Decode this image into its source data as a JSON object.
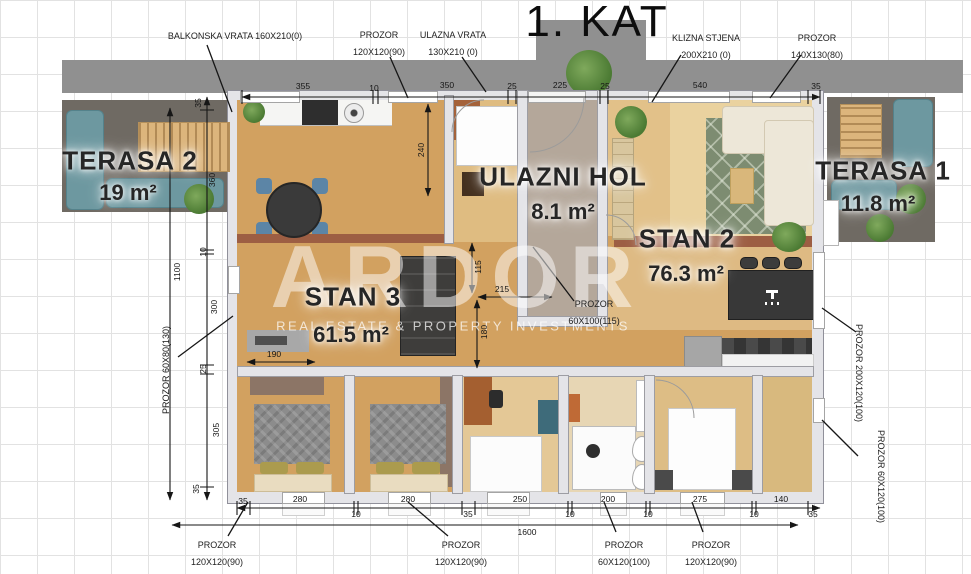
{
  "title": "1. KAT",
  "watermark": {
    "brand": "ARDOR",
    "tagline": "REAL ESTATE & PROPERTY INVESTMENTS"
  },
  "rooms": {
    "terasa2": {
      "name": "TERASA 2",
      "area": "19 m²"
    },
    "terasa1": {
      "name": "TERASA 1",
      "area": "11.8 m²"
    },
    "hol": {
      "name": "ULAZNI HOL",
      "area": "8.1 m²"
    },
    "stan2": {
      "name": "STAN 2",
      "area": "76.3 m²"
    },
    "stan3": {
      "name": "STAN 3",
      "area": "61.5 m²"
    }
  },
  "openings": {
    "top": [
      {
        "label": "BALKONSKA VRATA 160X210(0)",
        "size": ""
      },
      {
        "label": "PROZOR",
        "size": "120X120(90)"
      },
      {
        "label": "ULAZNA VRATA",
        "size": "130X210 (0)"
      },
      {
        "label": "KLIZNA STJENA",
        "size": "200X210 (0)"
      },
      {
        "label": "PROZOR",
        "size": "140X130(80)"
      }
    ],
    "bottom": [
      {
        "label": "PROZOR",
        "size": "120X120(90)"
      },
      {
        "label": "PROZOR",
        "size": "120X120(90)"
      },
      {
        "label": "PROZOR",
        "size": "60X120(100)"
      },
      {
        "label": "PROZOR",
        "size": "120X120(90)"
      }
    ],
    "left": {
      "label": "PROZOR 60X80(130)"
    },
    "right": [
      {
        "label": "PROZOR 200X120(100)"
      },
      {
        "label": "PROZOR 60X120(100)"
      }
    ],
    "center": {
      "label": "PROZOR",
      "size": "60X100(115)"
    }
  },
  "dims": {
    "top": [
      "355",
      "10",
      "350",
      "25",
      "225",
      "25",
      "540",
      "35"
    ],
    "left": [
      "35",
      "360",
      "10",
      "300",
      "25",
      "305",
      "35"
    ],
    "left_total": "1100",
    "bottom": [
      "35",
      "280",
      "10",
      "280",
      "35",
      "250",
      "10",
      "200",
      "10",
      "275",
      "10",
      "140",
      "35"
    ],
    "bottom_total": "1600",
    "interior": {
      "d240": "240",
      "d215": "215",
      "d115": "115",
      "d180": "180",
      "d190": "190"
    }
  },
  "colors": {
    "roof": "#909090",
    "terrace": "#6f6a63",
    "wood": "#d2a160",
    "wood_light": "#ead29f",
    "rug": "#7d8c71",
    "teal": "#6d98a0",
    "terracotta": "#9d5e43",
    "wall": "#e4e4e8"
  }
}
